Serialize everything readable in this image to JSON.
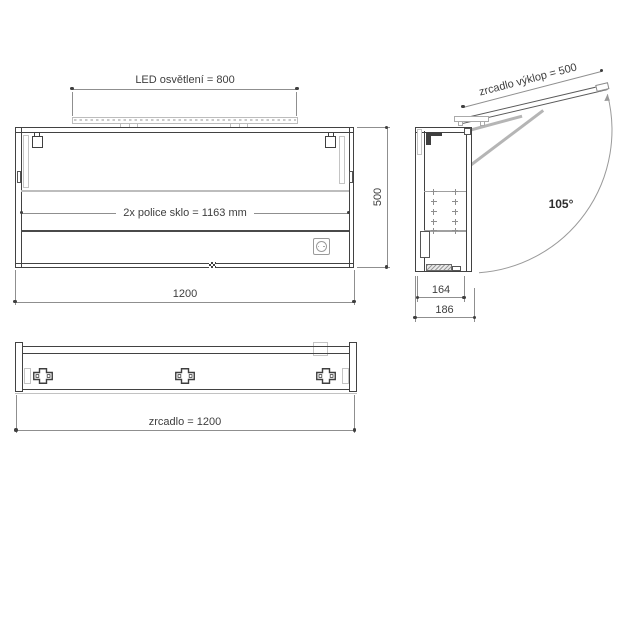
{
  "drawing": {
    "title": "mirror-cabinet-technical-drawing",
    "front_view": {
      "led_dimension": "LED osvětlení = 800",
      "shelf_dimension": "2x  police sklo = 1163 mm",
      "width_dimension": "1200",
      "height_dimension": "500"
    },
    "side_view": {
      "tilt_dimension": "zrcadlo výklop = 500",
      "opening_angle": "105°",
      "depth_inner_dimension": "164",
      "depth_outer_dimension": "186"
    },
    "bottom_view": {
      "mirror_width_dimension": "zrcadlo = 1200"
    },
    "colors": {
      "outline": "#424242",
      "dimension_line": "#8f8f8f",
      "light_gray_detail": "#c4c4c4",
      "text": "#3e3e3e",
      "background": "#ffffff"
    }
  }
}
